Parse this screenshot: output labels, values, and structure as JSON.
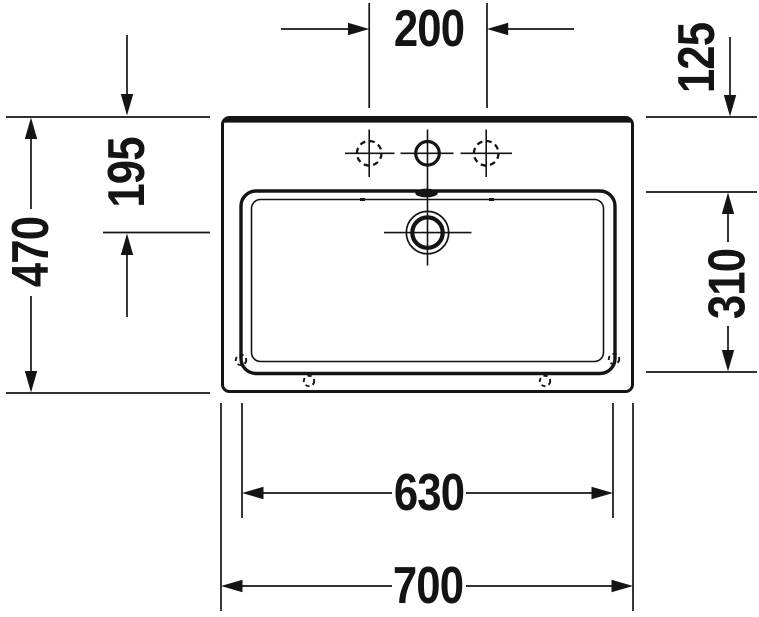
{
  "drawing": {
    "title": "Washbasin technical drawing, top view",
    "unit": "mm",
    "dimensions": {
      "tap_hole_spacing": "200",
      "rim_to_basin_edge": "125",
      "rim_to_drain_center": "195",
      "overall_depth": "470",
      "basin_depth": "310",
      "basin_width": "630",
      "overall_width": "700"
    },
    "features": {
      "tap_holes": "3 (center drilled, side holes optional dashed)",
      "drain": "center waste with crosshair",
      "overflow": "rear overflow slot",
      "mounting_holes": "4 dashed fixing holes"
    },
    "colors": {
      "line": "#141414",
      "background": "#ffffff"
    }
  }
}
